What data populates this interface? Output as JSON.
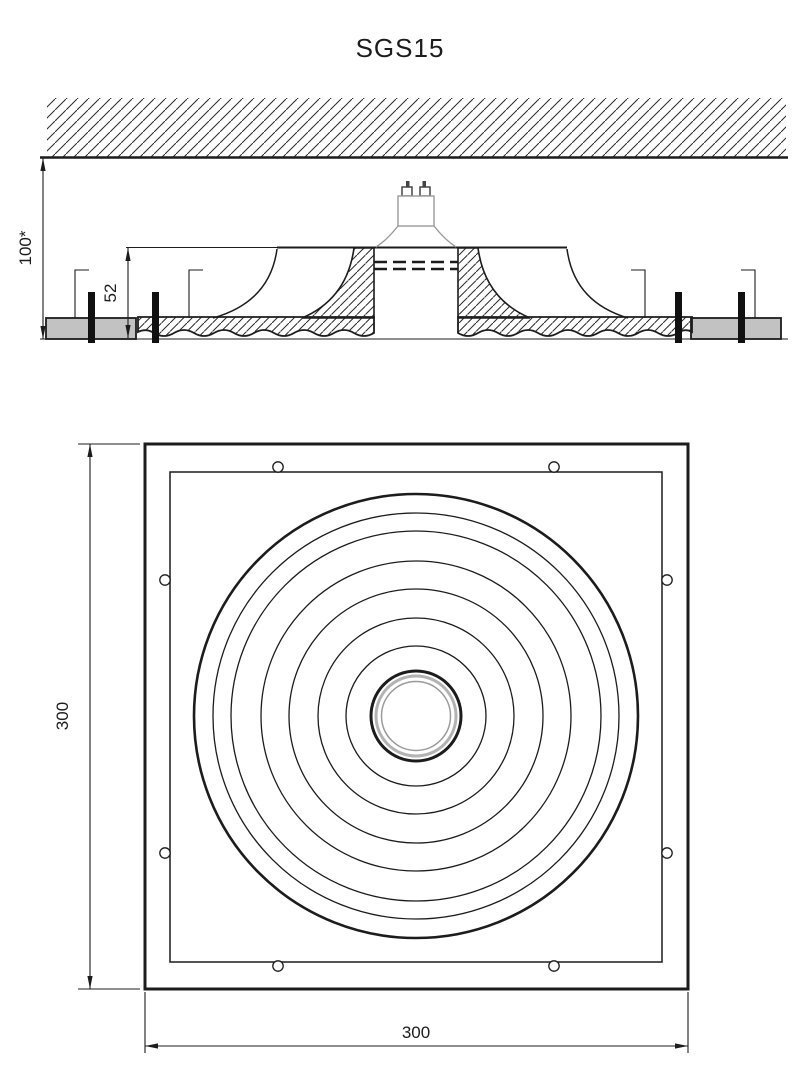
{
  "title": "SGS15",
  "drawing": {
    "type": "technical-drawing",
    "views": {
      "section_view": {
        "name": "ceiling section with recessed fitting",
        "dimensions": {
          "overall_recess_height": "100*",
          "fixture_height": "52"
        },
        "parts": [
          "ceiling-slab",
          "plasterboard",
          "fixing-screws",
          "spring-clips",
          "plaster-fixture",
          "gu10-lamp"
        ]
      },
      "plan_view": {
        "name": "bottom view of square fixture",
        "dimensions": {
          "width": "300",
          "height": "300"
        },
        "features": [
          "outer-frame",
          "inner-frame",
          "ripple-rings",
          "lamp-hole",
          "screw-holes"
        ]
      }
    }
  },
  "dims": {
    "overall_height": "100*",
    "recess_depth": "52",
    "plan_width": "300",
    "plan_height": "300"
  },
  "colors": {
    "ink": "#1c1c1c",
    "plasterboard_gray": "#c2c2c2",
    "lamp_gray": "#9a9a9a",
    "trim_ring_gray": "#b3b3b3",
    "trim_inner_gray": "#9a9a9a",
    "background": "#ffffff"
  }
}
